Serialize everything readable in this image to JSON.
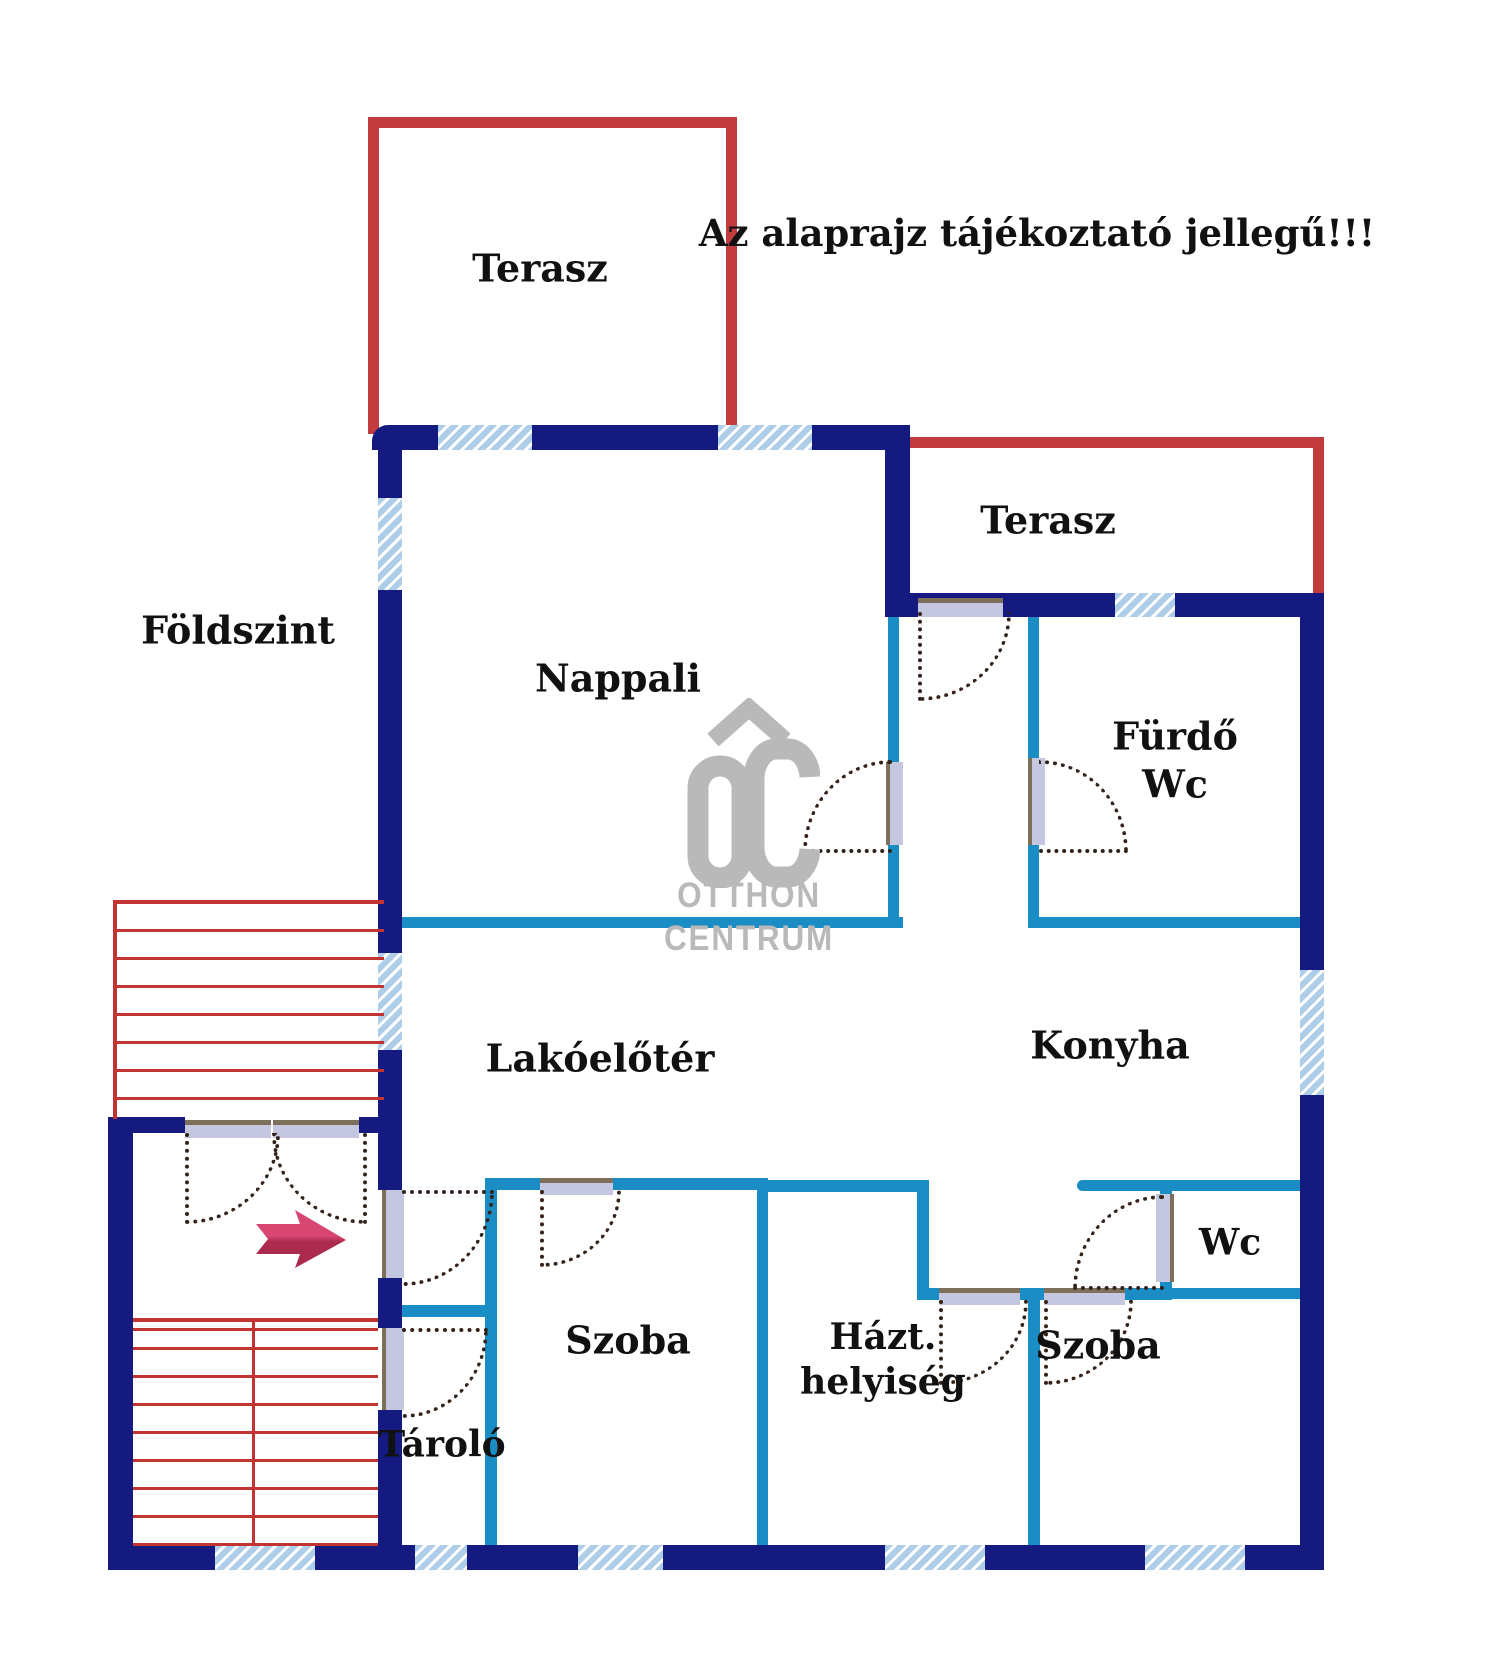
{
  "colors": {
    "navy": "#141a80",
    "cyan": "#1b8dc5",
    "red": "#c23b3d",
    "stair": "#c13431",
    "arrow": "#d23a64",
    "arrow-dark": "#aa2b4e",
    "hatch": "#aecde9",
    "gray": "#b9b9b9",
    "leaf": "#c5c6e0",
    "brown": "#7d6f5a",
    "arc": "#33231a",
    "ink": "#111111"
  },
  "labels": {
    "warning": "Az alaprajz tájékoztató jellegű!!!",
    "terasz_top": "Terasz",
    "terasz_right": "Terasz",
    "foldszint": "Földszint",
    "nappali": "Nappali",
    "furdo_line1": "Fürdő",
    "furdo_line2": "Wc",
    "lakoeloter": "Lakóelőtér",
    "konyha": "Konyha",
    "wc_small": "Wc",
    "szoba_left": "Szoba",
    "hazt_line1": "Házt.",
    "hazt_line2": "helyiség",
    "szoba_right": "Szoba",
    "tarolo": "Tároló"
  },
  "logo": {
    "line1": "OTTHON",
    "line2": "CENTRUM"
  }
}
